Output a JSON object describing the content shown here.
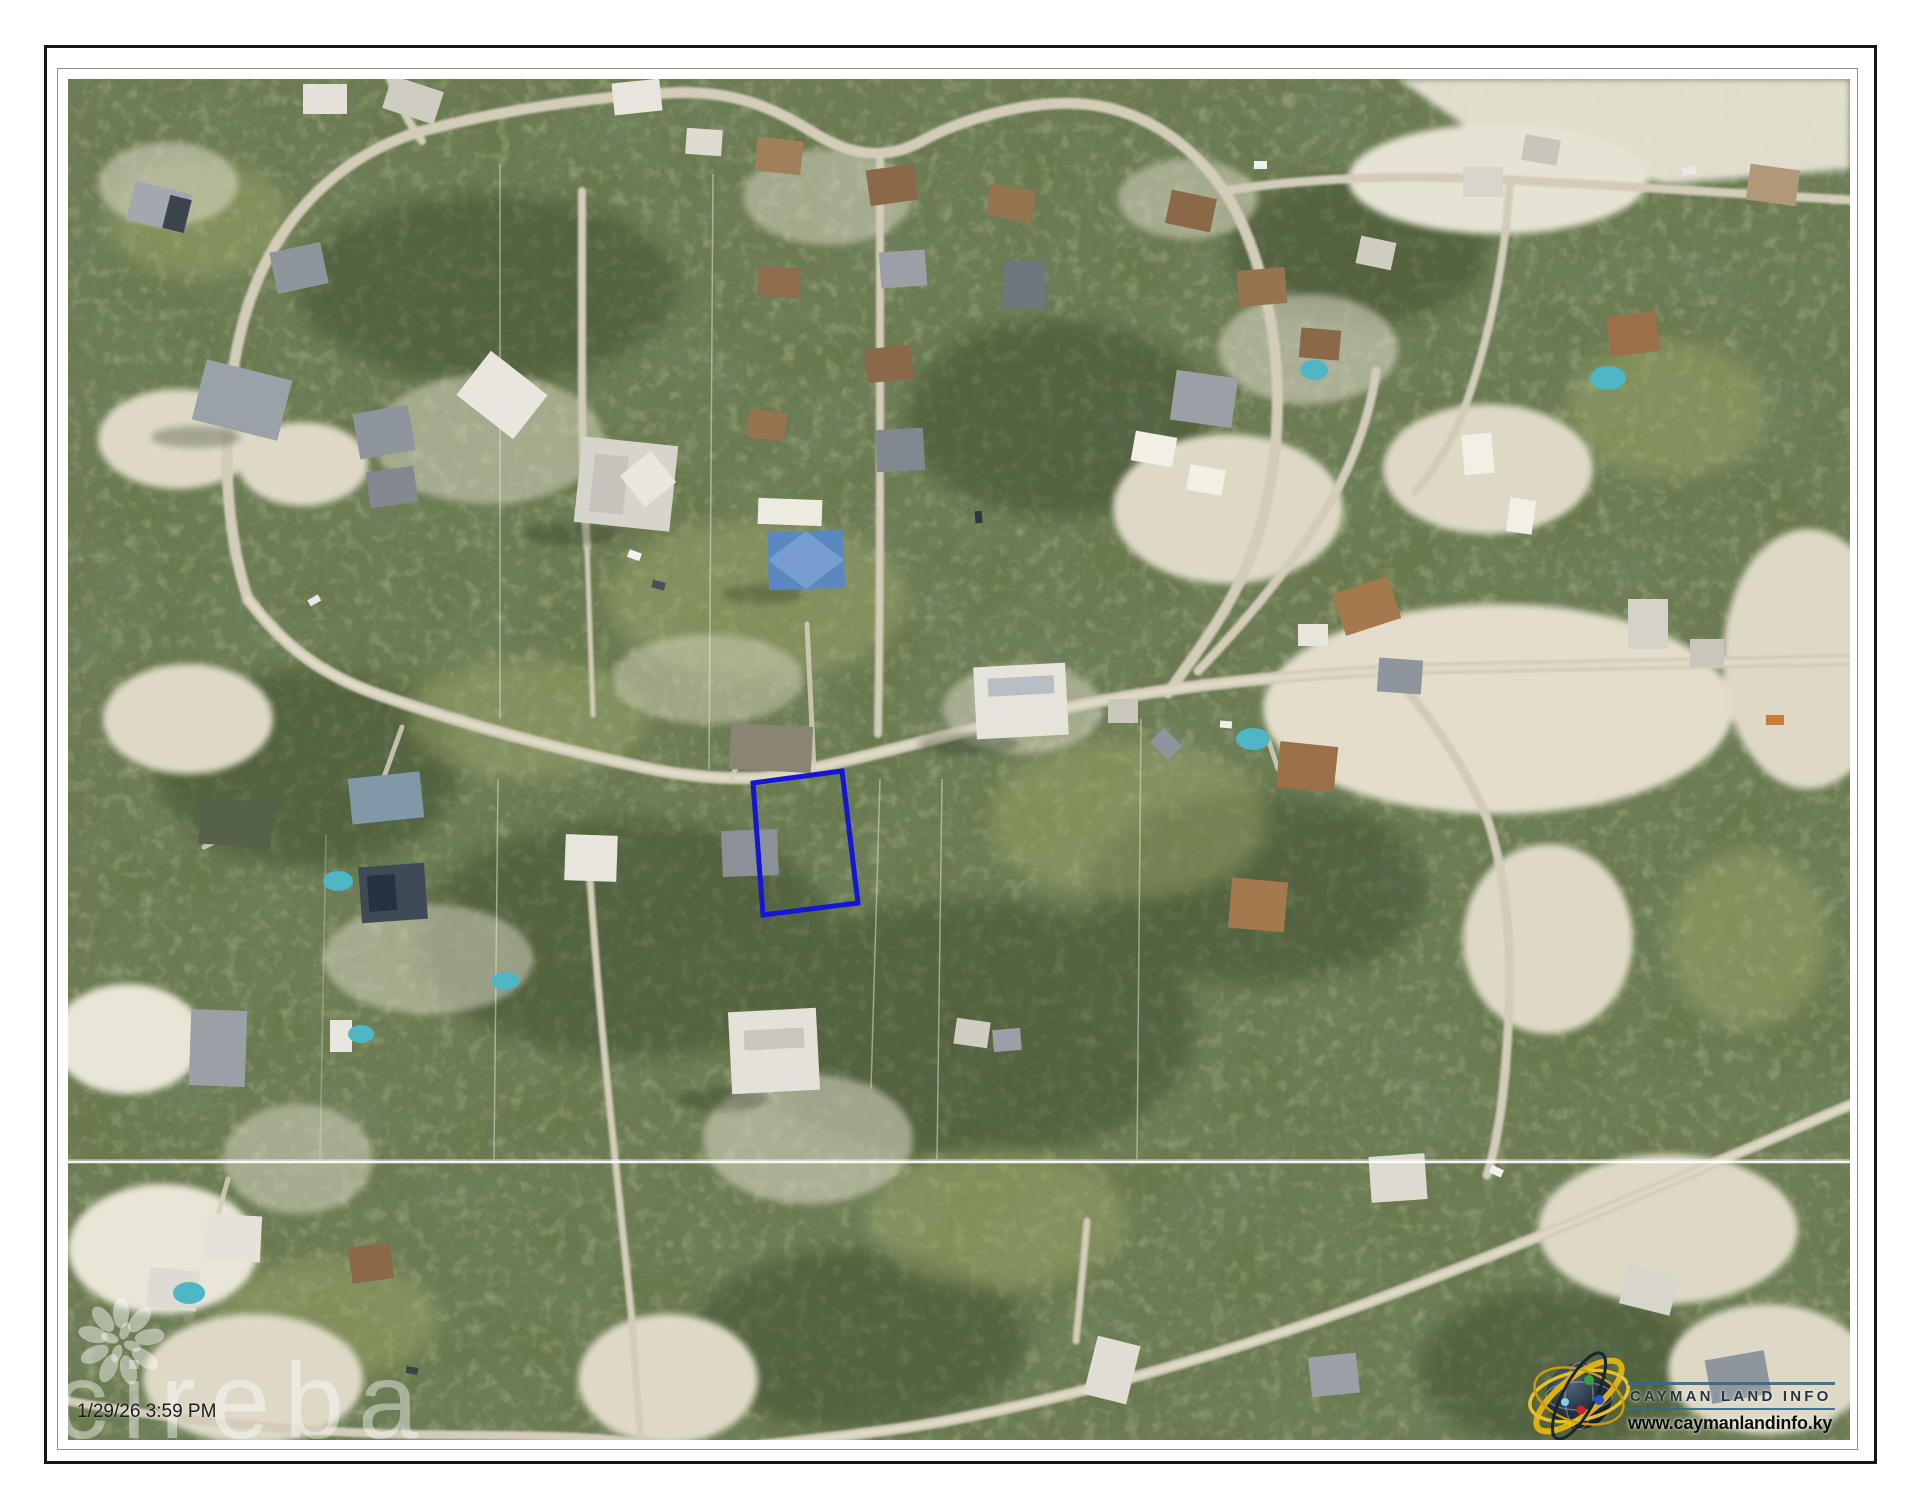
{
  "photo": {
    "timestamp": "1/29/26 3:59 PM"
  },
  "watermark": {
    "text": "cireba",
    "icon": "cireba-flower-icon",
    "color": "#ffffff"
  },
  "parcel": {
    "outline_color": "#1515d6"
  },
  "branding": {
    "name": "CAYMAN LAND INFO",
    "url": "www.caymanlandinfo.ky",
    "logo_icon": "globe-orbits-icon",
    "rule_color": "#35688a",
    "name_color": "#25343f",
    "url_color": "#0e0e0e"
  }
}
